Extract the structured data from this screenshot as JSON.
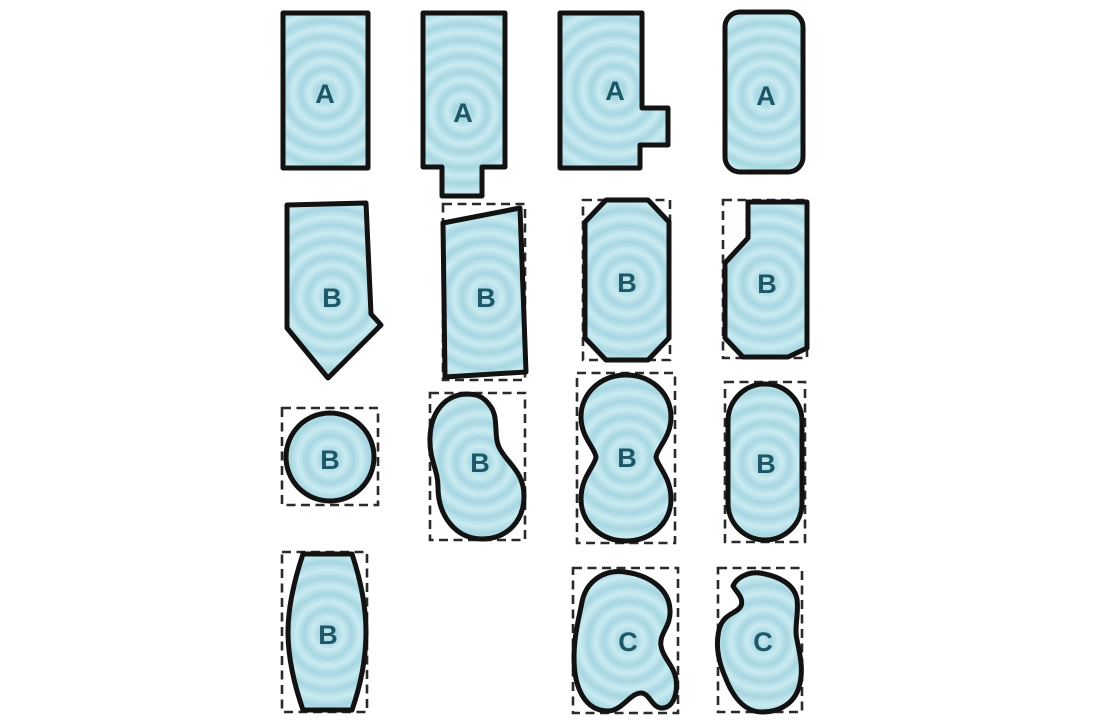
{
  "diagram": {
    "description": "Grid of pool shape outlines with water ripple fill, grouped by letter category",
    "rows": 4,
    "columns": 4
  },
  "colors": {
    "background": "#ffffff",
    "water_base": "#b9e1e9",
    "ripple_light": "#c9ebf1",
    "ripple_dark": "#a7d6e1",
    "outline": "#121212",
    "dashed_box_color": "#2a2a2a",
    "label_color": "#1c5767"
  },
  "pools": [
    {
      "label": "A",
      "shape": "rectangle",
      "dashed_box": false
    },
    {
      "label": "A",
      "shape": "rectangle-bottom-tab",
      "dashed_box": false
    },
    {
      "label": "A",
      "shape": "rectangle-right-step",
      "dashed_box": false
    },
    {
      "label": "A",
      "shape": "rounded-rectangle",
      "dashed_box": false
    },
    {
      "label": "B",
      "shape": "pointed-pentagon",
      "dashed_box": false
    },
    {
      "label": "B",
      "shape": "slant-top-quadrilateral",
      "dashed_box": true
    },
    {
      "label": "B",
      "shape": "octagon",
      "dashed_box": true
    },
    {
      "label": "B",
      "shape": "corner-notched-hexagon",
      "dashed_box": true
    },
    {
      "label": "B",
      "shape": "circle",
      "dashed_box": true
    },
    {
      "label": "B",
      "shape": "kidney",
      "dashed_box": true
    },
    {
      "label": "B",
      "shape": "figure-eight",
      "dashed_box": true
    },
    {
      "label": "B",
      "shape": "stadium",
      "dashed_box": true
    },
    {
      "label": "B",
      "shape": "barrel",
      "dashed_box": true
    },
    {
      "label": "C",
      "shape": "freeform-blob",
      "dashed_box": true
    },
    {
      "label": "C",
      "shape": "bean",
      "dashed_box": true
    }
  ]
}
